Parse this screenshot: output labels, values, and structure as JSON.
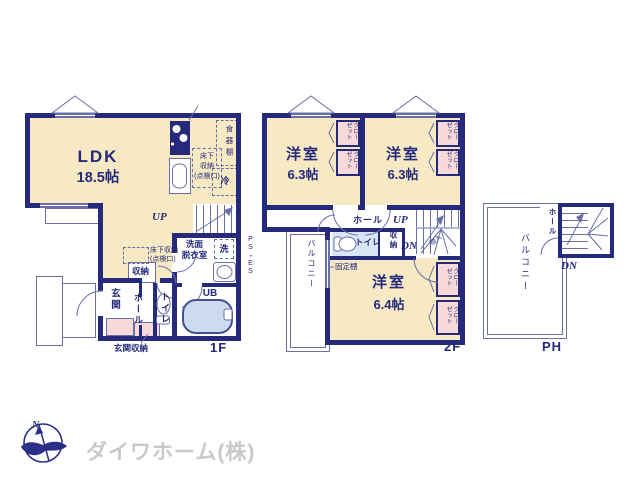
{
  "colors": {
    "wall": "#252a7a",
    "room_cream": "#f7e9c4",
    "closet_pink": "#f8d9da",
    "water_blue": "#d9e6f3",
    "line": "#6a6fa8",
    "logo_navy": "#2a2f88",
    "logo_gray": "#c9c9cd"
  },
  "f1": {
    "floor_label": "1F",
    "ldk": "LDK",
    "ldk_size": "18.5帖",
    "dish_shelf": "食器棚",
    "fridge": "冷",
    "underfloor_kitchen": [
      "床下",
      "収納",
      "(点検口)"
    ],
    "underfloor_hall": [
      "床下収納",
      "(点検口)"
    ],
    "up": "UP",
    "washroom": [
      "洗面",
      "脱衣室"
    ],
    "washer": "洗",
    "pipe_space": "PS・ES",
    "storage": "収納",
    "entrance": "玄関",
    "hall": "ホール",
    "toilet": "トイレ",
    "bath": "UB",
    "entrance_storage": "玄関収納"
  },
  "f2": {
    "floor_label": "2F",
    "room1": "洋室",
    "room1_size": "6.3帖",
    "room2": "洋室",
    "room2_size": "6.3帖",
    "room3": "洋室",
    "room3_size": "6.4帖",
    "closet": "クローゼット",
    "hall": "ホール",
    "up": "UP",
    "dn": "DN",
    "under_stairs": "物入",
    "toilet": "トイレ",
    "storage": "収納",
    "fixed_shelf": "固定棚",
    "balcony": "バルコニー"
  },
  "ph": {
    "floor_label": "PH",
    "balcony": "バルコニー",
    "hall": "ホール",
    "dn": "DN"
  },
  "logo": {
    "company": "ダイワホーム(株)",
    "north": "N"
  }
}
